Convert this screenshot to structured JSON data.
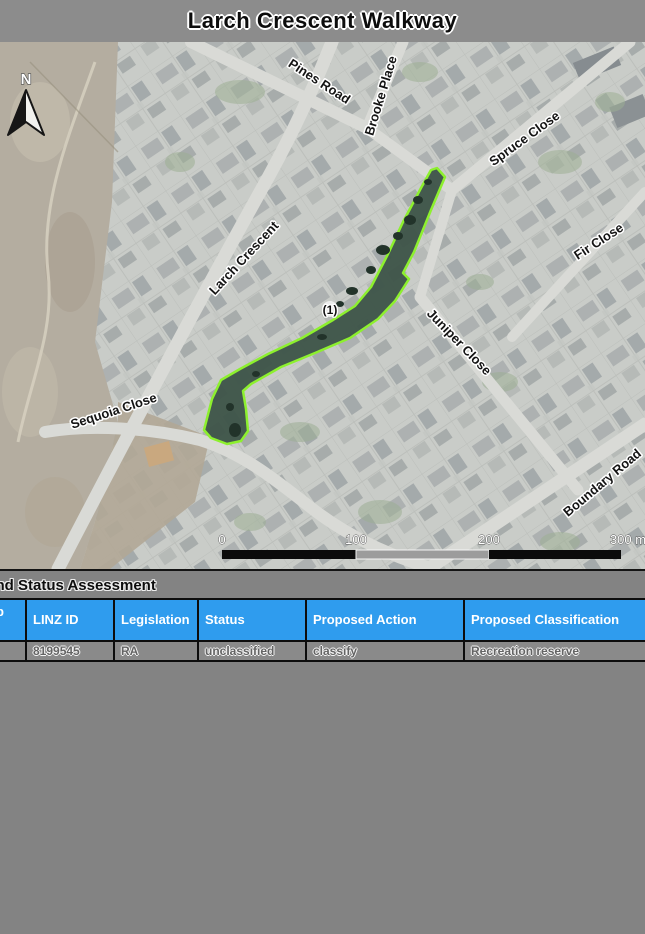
{
  "page": {
    "title": "Larch Crescent Walkway"
  },
  "map": {
    "north_label": "N",
    "parcel_label": "(1)",
    "road_labels": [
      "Pines Road",
      "Brooke Place",
      "Spruce Close",
      "Fir Close",
      "Larch Crescent",
      "Juniper Close",
      "Sequoia Close",
      "Boundary Road"
    ],
    "scale_bar": {
      "labels": [
        "0",
        "100",
        "200",
        "300 m"
      ]
    },
    "colors": {
      "parcel_outline": "#8df02e",
      "parcel_fill": "#3d5348"
    }
  },
  "assessment": {
    "heading": "Land Status Assessment",
    "table": {
      "header_color": "#2f9cee",
      "columns": [
        "Map ID",
        "LINZ ID",
        "Legislation",
        "Status",
        "Proposed Action",
        "Proposed Classification"
      ],
      "rows": [
        {
          "map_id": "",
          "linz_id": "8199545",
          "legislation": "RA",
          "status": "unclassified",
          "proposed_action": "classify",
          "proposed_classification": "Recreation reserve"
        }
      ]
    }
  }
}
